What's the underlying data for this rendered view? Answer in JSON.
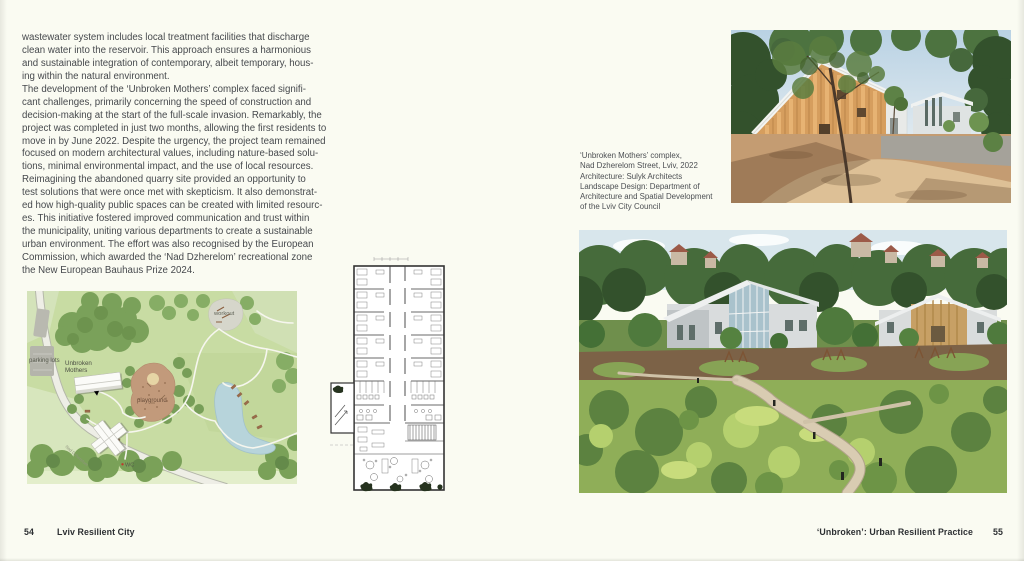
{
  "palette": {
    "page_background": "#fafbf2",
    "body_text": "#46494d",
    "footer_text": "#2c2f32",
    "map_base_green": "#c8dca3",
    "map_tree_green": "#7aa15a",
    "map_pond_blue": "#b7d4db",
    "map_playground_brown": "#c29a7b",
    "photo_timber_orange": "#d69e5e",
    "photo_sky_blue": "#c2d8e6"
  },
  "left_page": {
    "body": [
      {
        "lines": [
          "wastewater system includes local treatment facilities that discharge",
          "clean water into the reservoir. This approach ensures a harmonious",
          "and sustainable integration of contemporary, albeit temporary, hous-",
          "ing within the natural environment."
        ]
      },
      {
        "lines": [
          "The development of the ‘Unbroken Mothers’ complex faced signifi-",
          "cant challenges, primarily concerning the speed of construction and",
          "decision-making at the start of the full-scale invasion. Remarkably, the",
          "project was completed in just two months, allowing the first residents to",
          "move in by June 2022. Despite the urgency, the project team remained",
          "focused on modern architectural values, including nature-based solu-",
          "tions, minimal environmental impact, and the use of local resources."
        ]
      },
      {
        "lines": [
          "Reimagining the abandoned quarry site provided an opportunity to",
          "test solutions that were once met with skepticism. It also demonstrat-",
          "ed how high-quality public spaces can be created with limited resourc-",
          "es. This initiative fostered improved communication and trust within",
          "the municipality, uniting various departments to create a sustainable",
          "urban environment. The effort was also recognised by the European",
          "Commission, which awarded the ‘Nad Dzherelom’ recreational zone",
          "the New European Bauhaus Prize 2024."
        ]
      }
    ],
    "footer": {
      "page_number": "54",
      "section_title": "Lviv Resilient City"
    }
  },
  "right_page": {
    "caption": {
      "lines": [
        "‘Unbroken Mothers’ complex,",
        "Nad Dzherelom Street, Lviv, 2022",
        "Architecture: Sulyk Architects",
        "Landscape Design: Department of",
        "Architecture and Spatial Development",
        "of the Lviv City Council"
      ]
    },
    "footer": {
      "section_title": "‘Unbroken’: Urban Resilient Practice",
      "page_number": "55"
    }
  },
  "site_plan": {
    "labels": {
      "parking": "parking lots",
      "building_line1": "Unbroken",
      "building_line2": "Mothers",
      "playground": "playground",
      "workout": "workout",
      "wc": "WC",
      "street": "Nad Dzherelom"
    }
  }
}
